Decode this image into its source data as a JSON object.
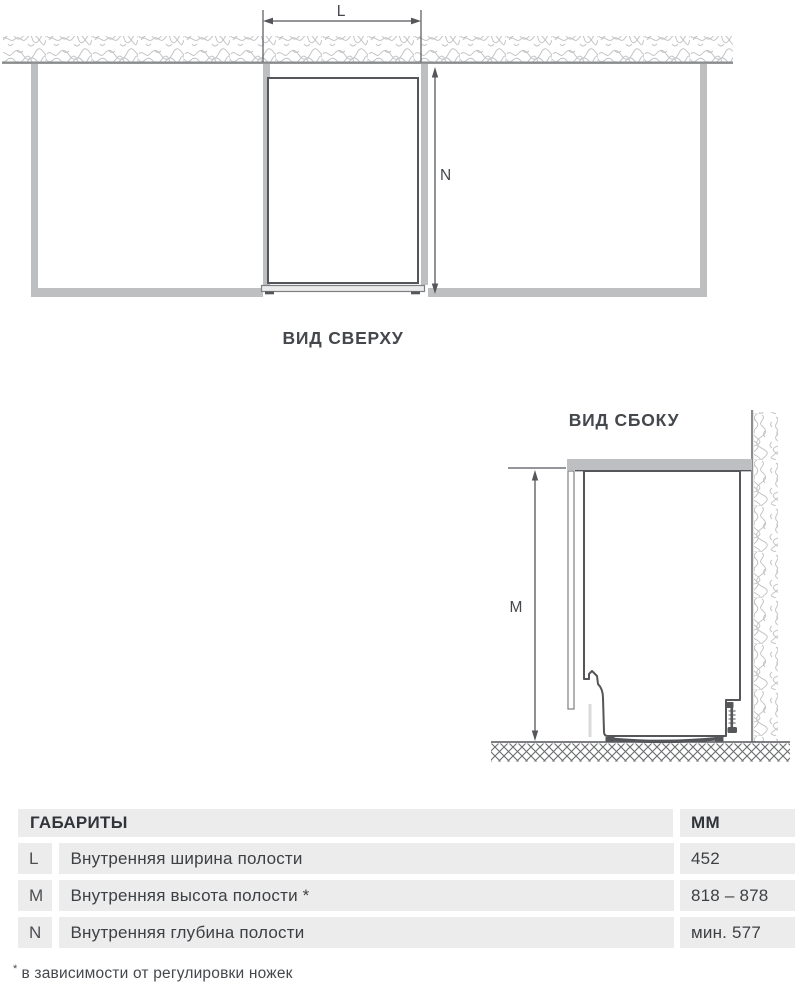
{
  "top_view": {
    "caption": "ВИД СВЕРХУ",
    "width_label": "L",
    "depth_label": "N"
  },
  "side_view": {
    "caption": "ВИД СБОКУ",
    "height_label": "M"
  },
  "table": {
    "header": {
      "title": "ГАБАРИТЫ",
      "unit": "ММ"
    },
    "rows": [
      {
        "key": "L",
        "label": "Внутренняя ширина полости",
        "value": "452"
      },
      {
        "key": "M",
        "label": "Внутренняя высота полости *",
        "value": "818 – 878"
      },
      {
        "key": "N",
        "label": "Внутренняя глубина полости",
        "value": "мин. 577"
      }
    ],
    "footnote_marker": "*",
    "footnote_text": "в зависимости от регулировки ножек"
  },
  "colors": {
    "cabinet_gray": "#bdbfc1",
    "outline_dark": "#54565a",
    "wall_line": "#8a8c8e",
    "hatch_light": "#c3c4c6",
    "ground_hatch": "#6a6c6f",
    "table_bg": "#ececec",
    "text": "#3d4044"
  }
}
